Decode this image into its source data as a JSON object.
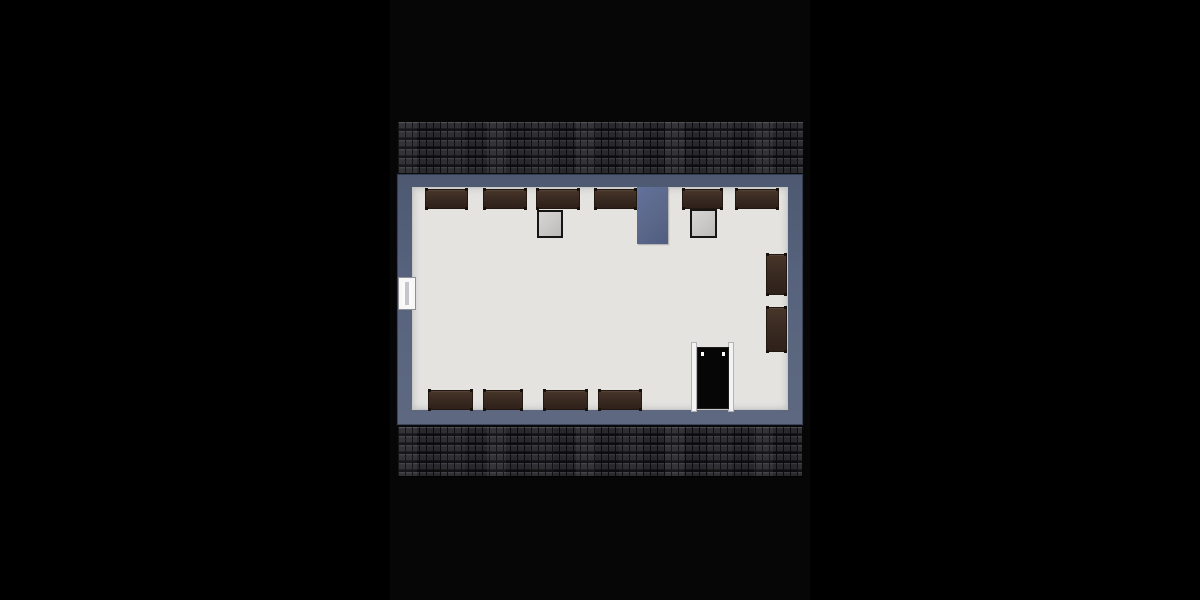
{
  "meta": {
    "description": "Top-down 3D rendered attic floor plan on a black backdrop, no visible text",
    "image_width": 1200,
    "image_height": 600
  },
  "palette": {
    "background": "#000000",
    "photo_backdrop": "#060606",
    "roof_tile": "#242428",
    "wall": "#57627c",
    "floor": "#e4e3e0",
    "furniture": "#3a2a22",
    "chimney": "#5b6889",
    "skylight": "#cac9c7",
    "door_leaf": "#060606",
    "door_frame": "#f3f3f3",
    "window_frame": "#f7f7f7"
  },
  "floorplan": {
    "photo_strip": {
      "x": 390,
      "y": 0,
      "w": 420,
      "h": 600
    },
    "roof_strips": [
      {
        "name": "roof-top",
        "x": 398,
        "y": 122,
        "w": 405,
        "h": 51
      },
      {
        "name": "roof-bottom",
        "x": 398,
        "y": 427,
        "w": 404,
        "h": 49
      }
    ],
    "building": {
      "x": 397,
      "y": 174,
      "w": 406,
      "h": 251
    },
    "floor": {
      "x": 412,
      "y": 187,
      "w": 376,
      "h": 223
    },
    "chimney": {
      "x": 637,
      "y": 187,
      "w": 31,
      "h": 57
    },
    "skylights": [
      {
        "name": "skylight-left",
        "x": 537,
        "y": 210,
        "w": 26,
        "h": 28
      },
      {
        "name": "skylight-right",
        "x": 690,
        "y": 209,
        "w": 27,
        "h": 29
      }
    ],
    "furniture": [
      {
        "name": "bench-top-1",
        "x": 425,
        "y": 189,
        "w": 43,
        "h": 20
      },
      {
        "name": "bench-top-2",
        "x": 483,
        "y": 189,
        "w": 44,
        "h": 20
      },
      {
        "name": "bench-top-3",
        "x": 536,
        "y": 189,
        "w": 44,
        "h": 20
      },
      {
        "name": "bench-top-4",
        "x": 594,
        "y": 189,
        "w": 43,
        "h": 20
      },
      {
        "name": "bench-top-5",
        "x": 682,
        "y": 189,
        "w": 41,
        "h": 20
      },
      {
        "name": "bench-top-6",
        "x": 735,
        "y": 189,
        "w": 44,
        "h": 20
      },
      {
        "name": "bench-bottom-1",
        "x": 428,
        "y": 390,
        "w": 45,
        "h": 20
      },
      {
        "name": "bench-bottom-2",
        "x": 483,
        "y": 390,
        "w": 40,
        "h": 20
      },
      {
        "name": "bench-bottom-3",
        "x": 543,
        "y": 390,
        "w": 45,
        "h": 20
      },
      {
        "name": "bench-bottom-4",
        "x": 598,
        "y": 390,
        "w": 44,
        "h": 20
      },
      {
        "name": "bench-right-1",
        "x": 766,
        "y": 254,
        "w": 21,
        "h": 41
      },
      {
        "name": "bench-right-2",
        "x": 766,
        "y": 307,
        "w": 21,
        "h": 45
      }
    ],
    "door": {
      "x": 691,
      "y": 342,
      "w": 43,
      "h": 70,
      "leaf": {
        "x": 698,
        "y": 348,
        "w": 30,
        "h": 60
      }
    },
    "window": {
      "x": 398,
      "y": 277,
      "w": 18,
      "h": 33
    }
  }
}
